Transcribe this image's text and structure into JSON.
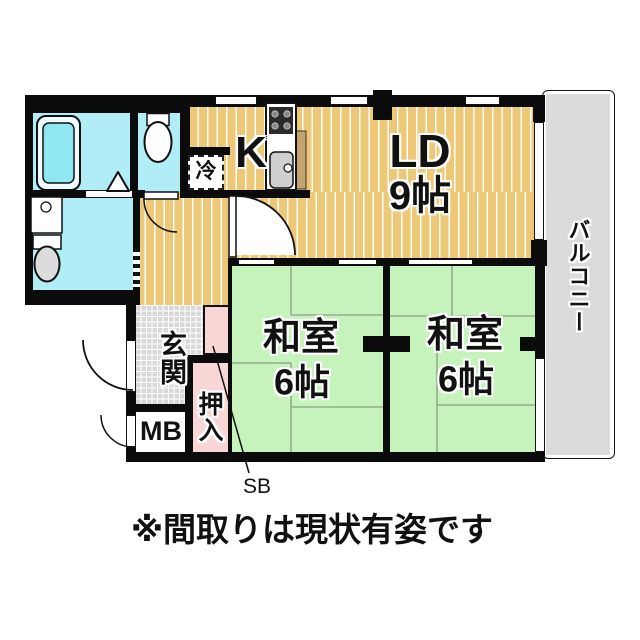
{
  "caption": "※間取りは現状有姿です",
  "rooms": {
    "kitchen": {
      "label": "K"
    },
    "living_dining": {
      "label": "LD",
      "size": "9帖"
    },
    "japanese_room_left": {
      "label": "和室",
      "size": "6帖"
    },
    "japanese_room_right": {
      "label": "和室",
      "size": "6帖"
    },
    "entrance": {
      "label": "玄関"
    },
    "closet": {
      "label": "押入"
    },
    "meter_box": {
      "label": "MB"
    },
    "shoe_box": {
      "label": "SB"
    },
    "refrigerator": {
      "label": "冷"
    },
    "balcony": {
      "label": "バルコニー"
    }
  },
  "colors": {
    "flooring": "#edc977",
    "tatami": "#c6f2bb",
    "wet_area": "#b0edf6",
    "closet_pink": "#f8d6d6",
    "entrance_tile": "#d8d8d8",
    "balcony_gray": "#dbdbdb",
    "wall": "#0b0b0b"
  }
}
